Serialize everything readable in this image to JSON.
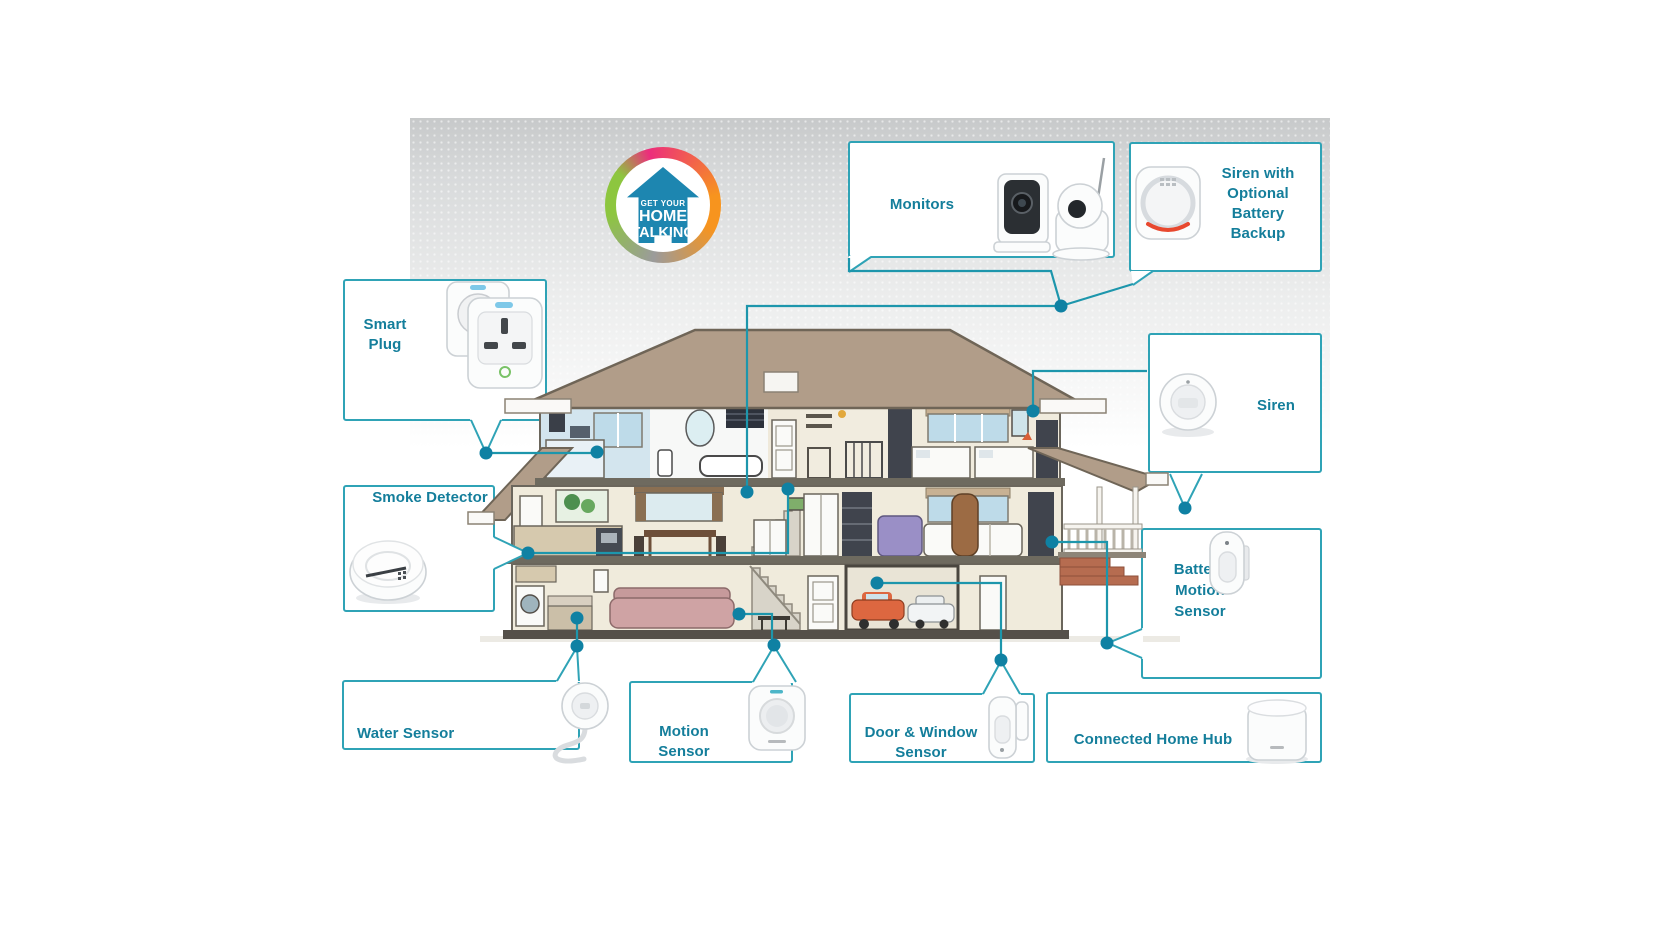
{
  "logo": {
    "top": "GET YOUR",
    "middle": "HOME",
    "bottom": "TALKING"
  },
  "labels": {
    "monitors": "Monitors",
    "siren_battery": "Siren with Optional Battery Backup",
    "smart_plug": "Smart Plug",
    "siren": "Siren",
    "smoke_detector": "Smoke Detector",
    "battery_motion_sensor": "Battery Motion Sensor",
    "water_sensor": "Water Sensor",
    "motion_sensor": "Motion Sensor",
    "door_window_sensor": "Door & Window Sensor",
    "connected_home_hub": "Connected Home Hub"
  },
  "colors": {
    "box_border": "#2fa3b6",
    "label_text": "#147e9b",
    "connector_line": "#1d96ac",
    "connector_dot": "#0f81a3",
    "roof": "#b19d89",
    "logo_house": "#1d86b0",
    "logo_ring": [
      "#8dc63f",
      "#ec2d7c",
      "#f7941e",
      "#9b9b9b"
    ]
  },
  "device_images": {
    "monitors": "wifi-cameras",
    "siren_battery": "siren-with-battery-backup",
    "smart_plug": "smart-plugs",
    "siren": "round-siren",
    "smoke_detector": "smoke-detector-puck",
    "battery_motion_sensor": "battery-motion-sensor",
    "water_sensor": "water-sensor-with-cable",
    "motion_sensor": "motion-sensor",
    "door_window_sensor": "door-window-sensor",
    "connected_home_hub": "home-hub-cylinder"
  }
}
